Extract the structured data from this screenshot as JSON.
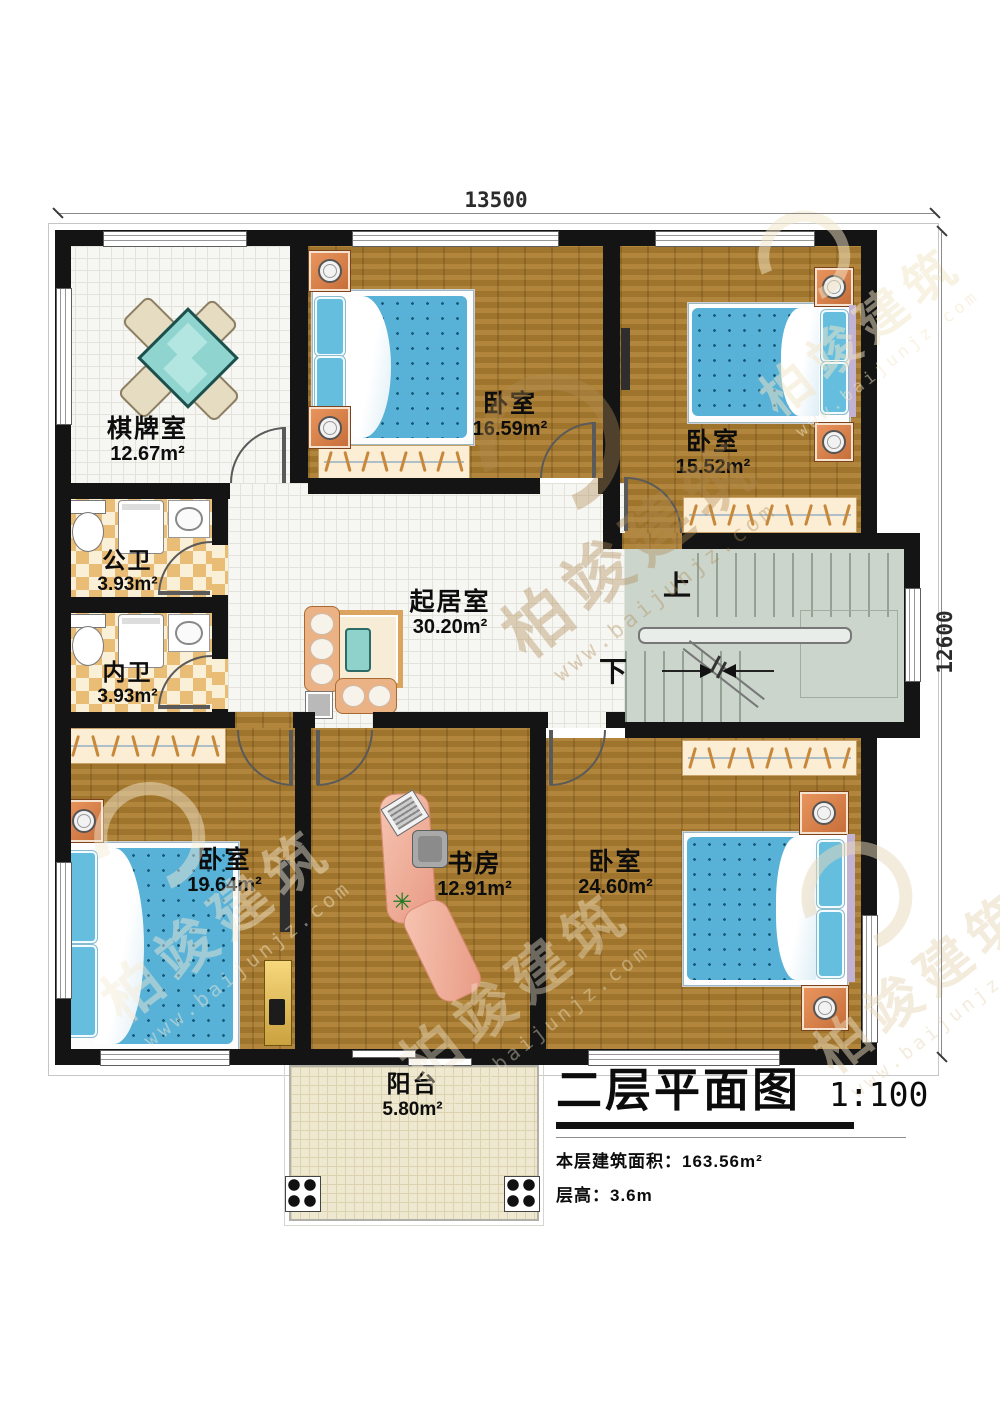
{
  "watermark": {
    "brand": "柏竣建筑",
    "url": "www.baijunjz.com"
  },
  "dimensions": {
    "top": "13500",
    "right": "12600"
  },
  "stairs": {
    "up": "上",
    "down": "下"
  },
  "rooms": {
    "chess": {
      "name": "棋牌室",
      "area": "12.67m²"
    },
    "bedroom_top_mid": {
      "name": "卧室",
      "area": "16.59m²"
    },
    "bedroom_top_right": {
      "name": "卧室",
      "area": "15.52m²"
    },
    "public_bath": {
      "name": "公卫",
      "area": "3.93m²"
    },
    "private_bath": {
      "name": "内卫",
      "area": "3.93m²"
    },
    "living": {
      "name": "起居室",
      "area": "30.20m²"
    },
    "bedroom_bottom_left": {
      "name": "卧室",
      "area": "19.64m²"
    },
    "study": {
      "name": "书房",
      "area": "12.91m²"
    },
    "bedroom_bottom_right": {
      "name": "卧室",
      "area": "24.60m²"
    },
    "balcony": {
      "name": "阳台",
      "area": "5.80m²"
    }
  },
  "title_block": {
    "title": "二层平面图",
    "scale": "1:100",
    "floor_area": "本层建筑面积：163.56m²",
    "floor_height": "层高：3.6m"
  }
}
